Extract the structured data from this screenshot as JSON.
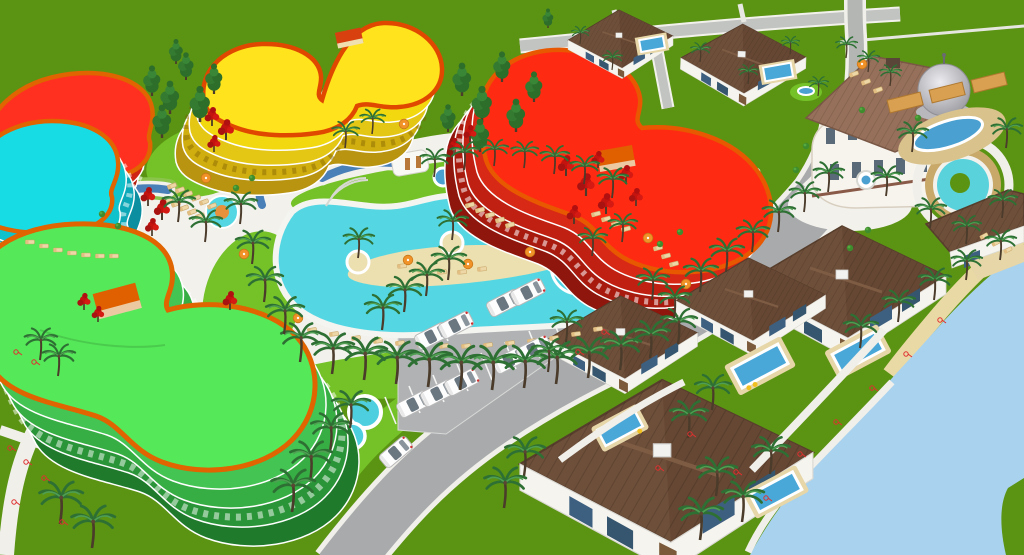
{
  "scene": {
    "kind": "3d-resort-masterplan-render",
    "colors": {
      "grass": "#5b9413",
      "lawn": "#74c228",
      "lawnStrip": "#68b81e",
      "sea": "#a8d2ee",
      "sand": "#e9d9a5",
      "islandSand": "#ecdfb0",
      "road": "#a8aaac",
      "roadLight": "#bfc1c1",
      "pathWhite": "#f0efe9",
      "deck": "#f2f1ec",
      "poolWater": "#55d7e3",
      "canalBlue": "#4a80b8",
      "spaBlue": "#4aa0d0",
      "villaPool": "#4aa8d8",
      "roofBrown": "#6e4f3a",
      "roofBrownDark": "#654733",
      "mansionRoof": "#96705a",
      "wallWhite": "#f6f4ee",
      "windowBlue": "#3e6080",
      "domeGrey": "#c0c0c4",
      "orangeTrim": "#e06400",
      "redRoof": "#ff2a12",
      "yellowRoof": "#ffe31c",
      "greenRoof": "#55e858",
      "cyanRoof": "#18dce4",
      "boxOrange": "#e06000",
      "pergola": "#d8a050",
      "fountainRing": "#c9a96a",
      "chairTan": "#eed7a6",
      "umbrellaOrange": "#f09228",
      "palmGreen": "#2e7034",
      "coniferGreen": "#2d6e2b",
      "redTree": "#c41410",
      "carWhite": "#fdfdfd",
      "markRed": "#e03030"
    }
  },
  "stamps": [
    {
      "symbol": "sym-palm",
      "layer": "layer-palms",
      "name": "palm-tree",
      "items": [
        [
          300,
          362,
          1.1
        ],
        [
          332,
          374,
          1.15
        ],
        [
          364,
          380,
          1.2
        ],
        [
          396,
          384,
          1.2
        ],
        [
          428,
          387,
          1.25
        ],
        [
          460,
          390,
          1.25
        ],
        [
          492,
          390,
          1.25
        ],
        [
          524,
          388,
          1.2
        ],
        [
          556,
          384,
          1.2
        ],
        [
          588,
          378,
          1.15
        ],
        [
          620,
          370,
          1.1
        ],
        [
          650,
          358,
          1.05
        ],
        [
          678,
          344,
          1.0
        ],
        [
          434,
          177,
          0.8
        ],
        [
          464,
          170,
          0.8
        ],
        [
          494,
          166,
          0.75
        ],
        [
          524,
          168,
          0.75
        ],
        [
          554,
          174,
          0.8
        ],
        [
          584,
          184,
          0.8
        ],
        [
          612,
          198,
          0.85
        ],
        [
          240,
          224,
          0.9
        ],
        [
          252,
          264,
          0.95
        ],
        [
          264,
          302,
          1.0
        ],
        [
          284,
          334,
          1.05
        ],
        [
          358,
          258,
          0.85
        ],
        [
          452,
          240,
          0.85
        ],
        [
          178,
          222,
          0.9
        ],
        [
          205,
          242,
          0.9
        ],
        [
          345,
          148,
          0.75
        ],
        [
          372,
          134,
          0.7
        ],
        [
          592,
          256,
          0.8
        ],
        [
          622,
          242,
          0.8
        ],
        [
          382,
          330,
          1.0
        ],
        [
          404,
          312,
          1.0
        ],
        [
          426,
          296,
          0.95
        ],
        [
          448,
          280,
          0.95
        ],
        [
          700,
          292,
          0.95
        ],
        [
          726,
          272,
          0.95
        ],
        [
          752,
          252,
          0.9
        ],
        [
          778,
          232,
          0.9
        ],
        [
          804,
          212,
          0.85
        ],
        [
          828,
          192,
          0.85
        ],
        [
          330,
          452,
          1.1
        ],
        [
          310,
          482,
          1.15
        ],
        [
          292,
          512,
          1.2
        ],
        [
          350,
          428,
          1.05
        ],
        [
          566,
          342,
          0.9
        ],
        [
          548,
          372,
          0.95
        ],
        [
          712,
          410,
          1.0
        ],
        [
          688,
          438,
          1.05
        ],
        [
          860,
          348,
          0.95
        ],
        [
          898,
          322,
          0.9
        ],
        [
          934,
          300,
          0.9
        ],
        [
          966,
          280,
          0.85
        ],
        [
          1000,
          260,
          0.85
        ],
        [
          716,
          496,
          1.1
        ],
        [
          742,
          522,
          1.15
        ],
        [
          700,
          540,
          1.2
        ],
        [
          770,
          474,
          1.05
        ],
        [
          912,
          152,
          0.85
        ],
        [
          1006,
          148,
          0.85
        ],
        [
          930,
          228,
          0.85
        ],
        [
          1002,
          218,
          0.8
        ],
        [
          886,
          196,
          0.85
        ],
        [
          966,
          244,
          0.8
        ],
        [
          846,
          58,
          0.6
        ],
        [
          868,
          72,
          0.6
        ],
        [
          890,
          86,
          0.6
        ],
        [
          700,
          62,
          0.55
        ],
        [
          748,
          84,
          0.55
        ],
        [
          790,
          54,
          0.5
        ],
        [
          818,
          96,
          0.55
        ],
        [
          612,
          70,
          0.55
        ],
        [
          580,
          44,
          0.5
        ],
        [
          60,
          524,
          1.2
        ],
        [
          92,
          548,
          1.2
        ],
        [
          40,
          360,
          0.9
        ],
        [
          58,
          376,
          0.9
        ],
        [
          524,
          476,
          1.1
        ],
        [
          504,
          508,
          1.15
        ],
        [
          652,
          300,
          0.9
        ],
        [
          674,
          318,
          0.9
        ]
      ]
    },
    {
      "symbol": "sym-conifer",
      "layer": "layer-trees",
      "name": "conifer-tree",
      "items": [
        [
          152,
          96,
          1.1
        ],
        [
          170,
          114,
          1.2
        ],
        [
          186,
          80,
          1.0
        ],
        [
          200,
          122,
          1.3
        ],
        [
          214,
          94,
          1.1
        ],
        [
          162,
          138,
          1.2
        ],
        [
          176,
          64,
          0.9
        ],
        [
          462,
          96,
          1.2
        ],
        [
          482,
          122,
          1.3
        ],
        [
          502,
          82,
          1.1
        ],
        [
          516,
          132,
          1.2
        ],
        [
          534,
          102,
          1.1
        ],
        [
          480,
          152,
          1.2
        ],
        [
          448,
          132,
          1.0
        ],
        [
          548,
          28,
          0.7
        ]
      ]
    },
    {
      "symbol": "sym-redtree",
      "layer": "layer-trees",
      "name": "red-tree",
      "items": [
        [
          212,
          126,
          1.0
        ],
        [
          226,
          140,
          1.1
        ],
        [
          214,
          152,
          0.9
        ],
        [
          148,
          206,
          1.0
        ],
        [
          162,
          220,
          1.1
        ],
        [
          152,
          236,
          0.95
        ],
        [
          230,
          310,
          1.0
        ],
        [
          566,
          176,
          1.1
        ],
        [
          586,
          196,
          1.2
        ],
        [
          606,
          214,
          1.1
        ],
        [
          626,
          184,
          1.0
        ],
        [
          598,
          168,
          0.9
        ],
        [
          574,
          224,
          1.0
        ],
        [
          636,
          206,
          0.95
        ],
        [
          470,
          142,
          0.9
        ],
        [
          454,
          154,
          0.85
        ],
        [
          84,
          310,
          0.9
        ],
        [
          98,
          322,
          0.85
        ]
      ]
    },
    {
      "symbol": "sym-shrub",
      "layer": "layer-trees",
      "name": "shrub",
      "items": [
        [
          868,
          230,
          1
        ],
        [
          850,
          248,
          1
        ],
        [
          806,
          146,
          1
        ],
        [
          796,
          170,
          1
        ],
        [
          918,
          118,
          1
        ],
        [
          862,
          110,
          1
        ],
        [
          102,
          214,
          1
        ],
        [
          118,
          226,
          1
        ],
        [
          236,
          188,
          1
        ],
        [
          252,
          178,
          1
        ],
        [
          660,
          244,
          1
        ],
        [
          680,
          232,
          1
        ]
      ]
    },
    {
      "symbol": "sym-chair",
      "layer": "layer-furniture",
      "name": "lounge-chair",
      "items": [
        [
          172,
          186,
          1,
          -20
        ],
        [
          180,
          190,
          1,
          -20
        ],
        [
          188,
          194,
          1,
          -20
        ],
        [
          196,
          198,
          1,
          -20
        ],
        [
          204,
          202,
          1,
          -20
        ],
        [
          212,
          206,
          1,
          -20
        ],
        [
          168,
          200,
          1,
          -20
        ],
        [
          176,
          204,
          1,
          -20
        ],
        [
          184,
          208,
          1,
          -20
        ],
        [
          192,
          212,
          1,
          -20
        ],
        [
          200,
          216,
          1,
          -20
        ],
        [
          470,
          205,
          1,
          -15
        ],
        [
          480,
          210,
          1,
          -15
        ],
        [
          490,
          215,
          1,
          -15
        ],
        [
          500,
          220,
          1,
          -15
        ],
        [
          510,
          225,
          1,
          -15
        ],
        [
          596,
          214,
          1,
          -15
        ],
        [
          606,
          219,
          1,
          -15
        ],
        [
          616,
          224,
          1,
          -15
        ],
        [
          626,
          229,
          1,
          -15
        ],
        [
          658,
          248,
          1,
          -15
        ],
        [
          666,
          256,
          1,
          -15
        ],
        [
          674,
          264,
          1,
          -15
        ],
        [
          312,
          330,
          1,
          -8
        ],
        [
          334,
          334,
          1,
          -8
        ],
        [
          356,
          338,
          1,
          -8
        ],
        [
          378,
          341,
          1,
          -8
        ],
        [
          400,
          343,
          1,
          -8
        ],
        [
          422,
          345,
          1,
          -8
        ],
        [
          444,
          346,
          1,
          -8
        ],
        [
          466,
          346,
          1,
          -8
        ],
        [
          488,
          345,
          1,
          -8
        ],
        [
          510,
          343,
          1,
          -8
        ],
        [
          532,
          341,
          1,
          -8
        ],
        [
          554,
          338,
          1,
          -8
        ],
        [
          576,
          334,
          1,
          -8
        ],
        [
          598,
          329,
          1,
          -8
        ],
        [
          402,
          266,
          1,
          -6
        ],
        [
          422,
          270,
          1,
          -6
        ],
        [
          442,
          272,
          1,
          -6
        ],
        [
          462,
          272,
          1,
          -6
        ],
        [
          482,
          269,
          1,
          -6
        ],
        [
          30,
          242,
          1,
          0
        ],
        [
          44,
          246,
          1,
          0
        ],
        [
          58,
          250,
          1,
          0
        ],
        [
          72,
          253,
          1,
          0
        ],
        [
          86,
          255,
          1,
          0
        ],
        [
          100,
          256,
          1,
          0
        ],
        [
          114,
          256,
          1,
          0
        ],
        [
          854,
          74,
          1,
          -20
        ],
        [
          866,
          82,
          1,
          -20
        ],
        [
          878,
          90,
          1,
          -20
        ],
        [
          984,
          236,
          0.9,
          -28
        ],
        [
          996,
          243,
          0.9,
          -28
        ],
        [
          1008,
          250,
          0.9,
          -28
        ]
      ]
    },
    {
      "symbol": "sym-umbrella",
      "layer": "layer-furniture",
      "name": "umbrella",
      "items": [
        [
          408,
          260,
          1
        ],
        [
          468,
          264,
          1
        ],
        [
          298,
          318,
          1
        ],
        [
          648,
          238,
          1
        ],
        [
          686,
          284,
          1
        ],
        [
          206,
          178,
          1
        ],
        [
          862,
          64,
          1
        ],
        [
          404,
          124,
          1
        ],
        [
          530,
          252,
          1
        ],
        [
          244,
          254,
          1
        ]
      ]
    },
    {
      "symbol": "sym-car",
      "layer": "layer-cars",
      "name": "parked-car",
      "items": [
        [
          414,
          404,
          1,
          -27
        ],
        [
          438,
          393,
          1,
          -27
        ],
        [
          462,
          382,
          1,
          -27
        ],
        [
          510,
          360,
          1,
          -27
        ],
        [
          534,
          349,
          1,
          -27
        ],
        [
          432,
          336,
          1,
          -27
        ],
        [
          456,
          325,
          1,
          -27
        ],
        [
          504,
          303,
          1,
          -27
        ],
        [
          528,
          292,
          1,
          -27
        ],
        [
          396,
          452,
          1,
          -40
        ]
      ]
    },
    {
      "symbol": "sym-stall",
      "layer": "layer-parking-lines",
      "name": "parking-stall-line",
      "items": [
        [
          396,
          424,
          1
        ],
        [
          420,
          413,
          1
        ],
        [
          444,
          402,
          1
        ],
        [
          468,
          391,
          1
        ],
        [
          492,
          380,
          1
        ],
        [
          516,
          369,
          1
        ],
        [
          540,
          358,
          1
        ],
        [
          564,
          347,
          1
        ],
        [
          424,
          352,
          1
        ],
        [
          448,
          341,
          1
        ],
        [
          472,
          330,
          1
        ],
        [
          496,
          319,
          1
        ],
        [
          520,
          308,
          1
        ],
        [
          544,
          297,
          1
        ],
        [
          568,
          286,
          1
        ]
      ]
    },
    {
      "symbol": "sym-mark",
      "layer": "layer-marks",
      "name": "survey-mark",
      "items": [
        [
          16,
          352,
          1
        ],
        [
          34,
          362,
          1
        ],
        [
          10,
          448,
          1
        ],
        [
          26,
          462,
          1
        ],
        [
          44,
          478,
          1
        ],
        [
          14,
          502,
          1
        ],
        [
          62,
          522,
          1
        ],
        [
          736,
          472,
          1
        ],
        [
          766,
          498,
          1
        ],
        [
          800,
          454,
          1
        ],
        [
          836,
          422,
          1
        ],
        [
          872,
          388,
          1
        ],
        [
          906,
          354,
          1
        ],
        [
          940,
          320,
          1
        ],
        [
          690,
          434,
          1
        ],
        [
          658,
          468,
          1
        ],
        [
          604,
          332,
          1
        ],
        [
          578,
          352,
          1
        ]
      ]
    }
  ]
}
